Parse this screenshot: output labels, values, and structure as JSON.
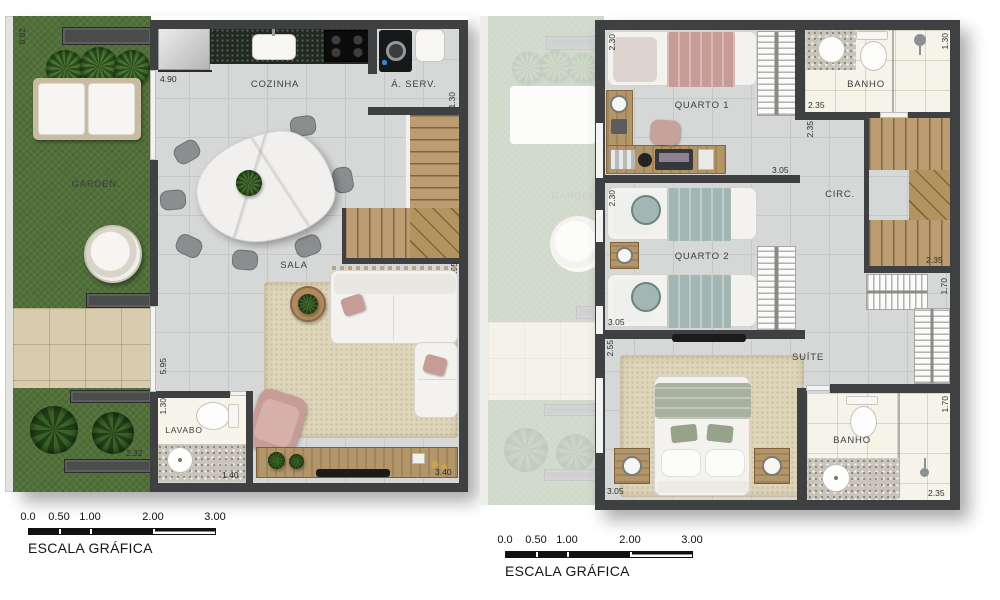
{
  "colors": {
    "grass": "#507038",
    "wall": "#3e4041",
    "wood": "#b3956a",
    "floor": "#d6d8d7",
    "rug": "#ded5ba",
    "patio": "#d9cbae",
    "pink": "#c79c97",
    "teal": "#a2b6b3",
    "sage": "#a8b19d",
    "granite_dark": "#202a20",
    "bath_floor": "#f6f4e8"
  },
  "left_plan": {
    "rooms": {
      "garden": "GARDEN.",
      "cozinha": "COZINHA",
      "aserv": "Á. SERV.",
      "sala": "SALA",
      "lavabo": "LAVABO"
    },
    "dims": {
      "garden_height": "8.82",
      "garden_bottom": "2.32",
      "kitchen_width": "4.90",
      "aserv_depth": "1.30",
      "sala_height_right": "5.95",
      "sala_height_left": "5.95",
      "lavabo_height": "1.30",
      "lavabo_width": "1.40",
      "sala_width": "3.40"
    }
  },
  "right_plan": {
    "rooms": {
      "quarto1": "QUARTO 1",
      "banho1": "BANHO",
      "circ": "CIRC.",
      "quarto2": "QUARTO 2",
      "suite": "SUÍTE",
      "banho2": "BANHO"
    },
    "dims": {
      "quarto1_height": "2.30",
      "quarto1_width": "3.05",
      "banho1_width": "2.35",
      "banho1_height": "1.30",
      "circ_height": "2.35",
      "stairs_width": "2.35",
      "quarto2_height": "2.30",
      "quarto2_width": "3.05",
      "closet_height": "1.70",
      "suite_height": "2.55",
      "suite_width": "3.05",
      "banho2_height": "1.70",
      "banho2_width": "2.35"
    }
  },
  "scale_bar": {
    "ticks": [
      "0.0",
      "0.50",
      "1.00",
      "2.00",
      "3.00"
    ],
    "label": "ESCALA GRÁFICA"
  }
}
